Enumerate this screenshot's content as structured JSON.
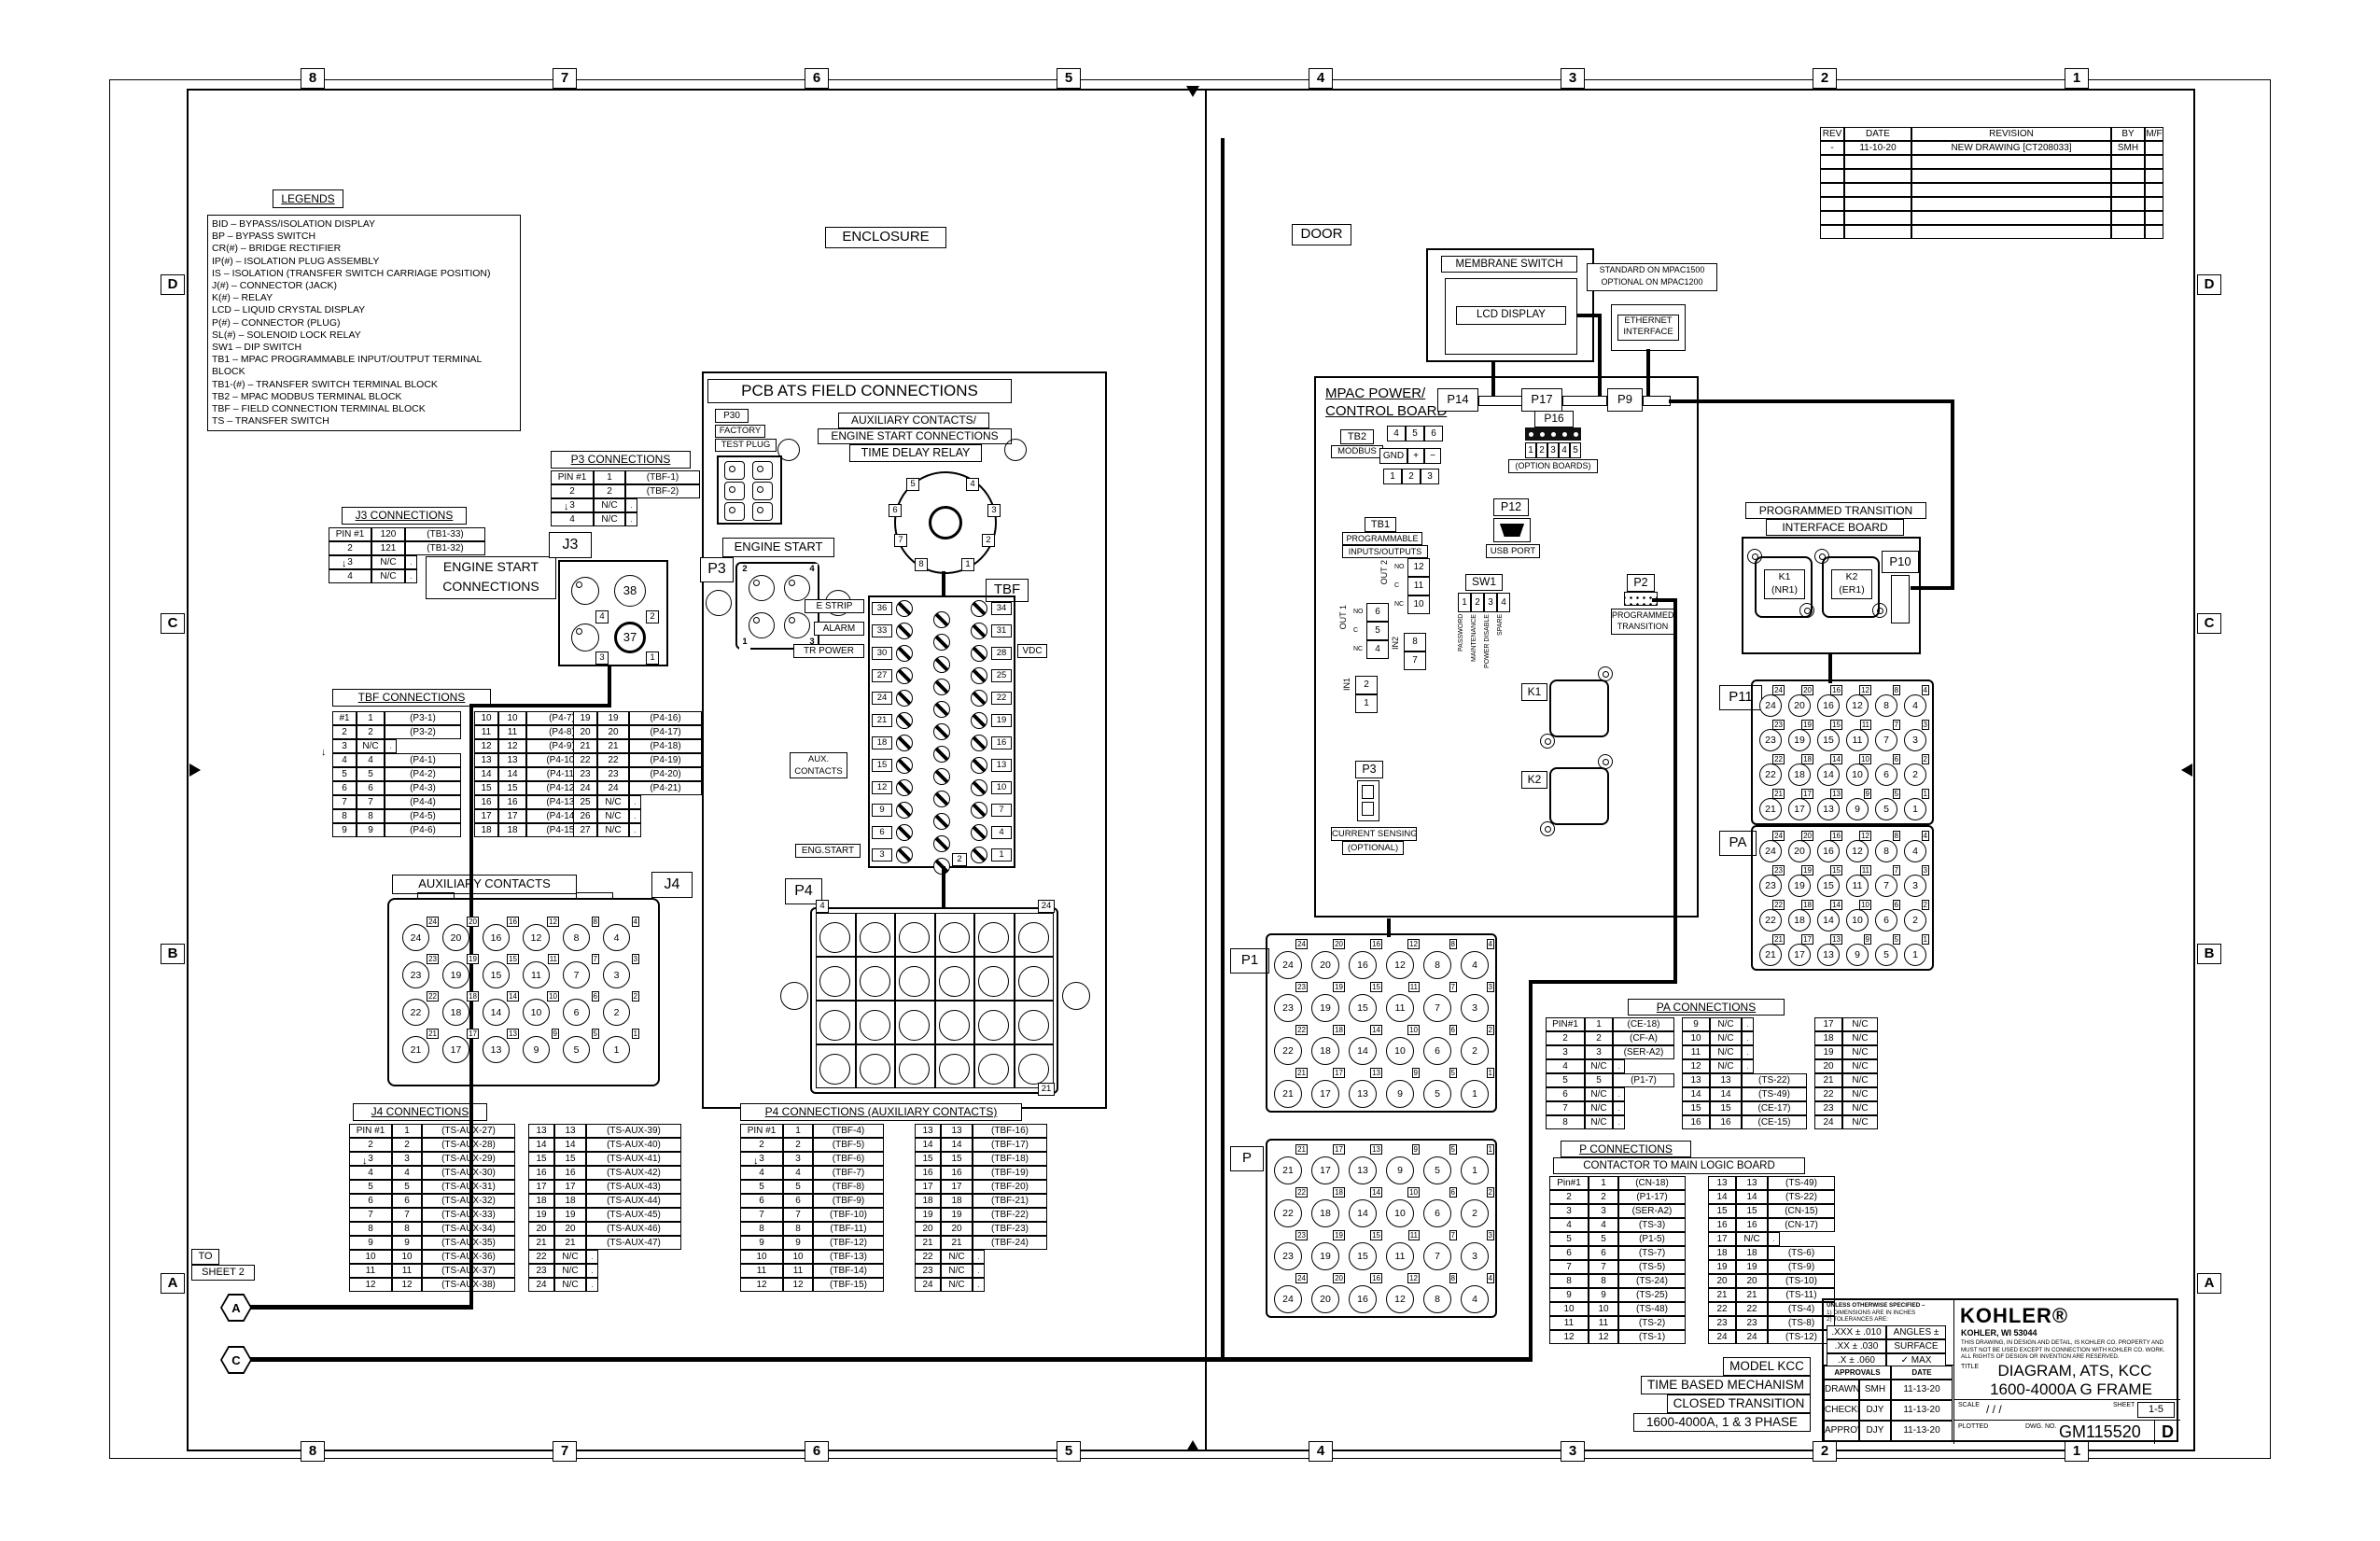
{
  "sheet": {
    "zone_cols": [
      "8",
      "7",
      "6",
      "5",
      "4",
      "3",
      "2",
      "1"
    ],
    "zone_rows": [
      "D",
      "C",
      "B",
      "A"
    ],
    "enclosure_label": "ENCLOSURE",
    "door_label": "DOOR",
    "to_sheet_1": "TO",
    "to_sheet_2": "SHEET 2",
    "flag_a": "A",
    "flag_c": "C"
  },
  "legends": {
    "title": "LEGENDS",
    "entries": [
      "BID  –  BYPASS/ISOLATION DISPLAY",
      "BP  –  BYPASS SWITCH",
      "CR(#)  –  BRIDGE RECTIFIER",
      "IP(#)  –  ISOLATION PLUG ASSEMBLY",
      "IS  –  ISOLATION (TRANSFER SWITCH CARRIAGE POSITION)",
      "J(#)  –  CONNECTOR (JACK)",
      "K(#)  –  RELAY",
      "LCD  –  LIQUID CRYSTAL DISPLAY",
      "P(#)  –  CONNECTOR (PLUG)",
      "SL(#) –  SOLENOID LOCK RELAY",
      "SW1  –  DIP SWITCH",
      "TB1  –  MPAC PROGRAMMABLE INPUT/OUTPUT TERMINAL BLOCK",
      "TB1-(#)  –  TRANSFER SWITCH TERMINAL BLOCK",
      "TB2  –  MPAC  MODBUS TERMINAL BLOCK",
      "TBF  –  FIELD CONNECTION TERMINAL BLOCK",
      "TS  –  TRANSFER SWITCH"
    ]
  },
  "revisions": {
    "rows": [
      [
        "REV",
        "DATE",
        "REVISION",
        "BY",
        "M/F"
      ],
      [
        "-",
        "11-10-20",
        "NEW DRAWING [CT208033]",
        "SMH",
        ""
      ],
      [
        "",
        "",
        "",
        "",
        ""
      ],
      [
        "",
        "",
        "",
        "",
        ""
      ],
      [
        "",
        "",
        "",
        "",
        ""
      ],
      [
        "",
        "",
        "",
        "",
        ""
      ],
      [
        "",
        "",
        "",
        "",
        ""
      ],
      [
        "",
        "",
        "",
        "",
        ""
      ]
    ]
  },
  "tables": {
    "j3": {
      "title": "J3 CONNECTIONS",
      "groups": [
        [
          [
            "PIN #1",
            "120",
            "(TB1-33)"
          ],
          [
            "2",
            "121",
            "(TB1-32)"
          ],
          [
            "3",
            "N/C",
            "."
          ],
          [
            "4",
            "N/C",
            "."
          ]
        ]
      ]
    },
    "p3": {
      "title": "P3 CONNECTIONS",
      "groups": [
        [
          [
            "PIN #1",
            "1",
            "(TBF-1)"
          ],
          [
            "2",
            "2",
            "(TBF-2)"
          ],
          [
            "3",
            "N/C",
            "."
          ],
          [
            "4",
            "N/C",
            "."
          ]
        ]
      ]
    },
    "tbf": {
      "title": "TBF CONNECTIONS",
      "groups": [
        [
          [
            "#1",
            "1",
            "(P3-1)"
          ],
          [
            "2",
            "2",
            "(P3-2)"
          ],
          [
            "3",
            "N/C",
            "."
          ],
          [
            "4",
            "4",
            "(P4-1)"
          ],
          [
            "5",
            "5",
            "(P4-2)"
          ],
          [
            "6",
            "6",
            "(P4-3)"
          ],
          [
            "7",
            "7",
            "(P4-4)"
          ],
          [
            "8",
            "8",
            "(P4-5)"
          ],
          [
            "9",
            "9",
            "(P4-6)"
          ]
        ],
        [
          [
            "10",
            "10",
            "(P4-7)"
          ],
          [
            "11",
            "11",
            "(P4-8)"
          ],
          [
            "12",
            "12",
            "(P4-9)"
          ],
          [
            "13",
            "13",
            "(P4-10)"
          ],
          [
            "14",
            "14",
            "(P4-11)"
          ],
          [
            "15",
            "15",
            "(P4-12)"
          ],
          [
            "16",
            "16",
            "(P4-13)"
          ],
          [
            "17",
            "17",
            "(P4-14)"
          ],
          [
            "18",
            "18",
            "(P4-15)"
          ]
        ],
        [
          [
            "19",
            "19",
            "(P4-16)"
          ],
          [
            "20",
            "20",
            "(P4-17)"
          ],
          [
            "21",
            "21",
            "(P4-18)"
          ],
          [
            "22",
            "22",
            "(P4-19)"
          ],
          [
            "23",
            "23",
            "(P4-20)"
          ],
          [
            "24",
            "24",
            "(P4-21)"
          ],
          [
            "25",
            "N/C",
            "."
          ],
          [
            "26",
            "N/C",
            "."
          ],
          [
            "27",
            "N/C",
            "."
          ]
        ]
      ]
    },
    "j4": {
      "title": "J4 CONNECTIONS",
      "groups": [
        [
          [
            "PIN #1",
            "1",
            "(TS-AUX-27)"
          ],
          [
            "2",
            "2",
            "(TS-AUX-28)"
          ],
          [
            "3",
            "3",
            "(TS-AUX-29)"
          ],
          [
            "4",
            "4",
            "(TS-AUX-30)"
          ],
          [
            "5",
            "5",
            "(TS-AUX-31)"
          ],
          [
            "6",
            "6",
            "(TS-AUX-32)"
          ],
          [
            "7",
            "7",
            "(TS-AUX-33)"
          ],
          [
            "8",
            "8",
            "(TS-AUX-34)"
          ],
          [
            "9",
            "9",
            "(TS-AUX-35)"
          ],
          [
            "10",
            "10",
            "(TS-AUX-36)"
          ],
          [
            "11",
            "11",
            "(TS-AUX-37)"
          ],
          [
            "12",
            "12",
            "(TS-AUX-38)"
          ]
        ],
        [
          [
            "13",
            "13",
            "(TS-AUX-39)"
          ],
          [
            "14",
            "14",
            "(TS-AUX-40)"
          ],
          [
            "15",
            "15",
            "(TS-AUX-41)"
          ],
          [
            "16",
            "16",
            "(TS-AUX-42)"
          ],
          [
            "17",
            "17",
            "(TS-AUX-43)"
          ],
          [
            "18",
            "18",
            "(TS-AUX-44)"
          ],
          [
            "19",
            "19",
            "(TS-AUX-45)"
          ],
          [
            "20",
            "20",
            "(TS-AUX-46)"
          ],
          [
            "21",
            "21",
            "(TS-AUX-47)"
          ],
          [
            "22",
            "N/C",
            "."
          ],
          [
            "23",
            "N/C",
            "."
          ],
          [
            "24",
            "N/C",
            "."
          ]
        ]
      ]
    },
    "p4": {
      "title": "P4 CONNECTIONS (AUXILIARY CONTACTS)",
      "groups": [
        [
          [
            "PIN #1",
            "1",
            "(TBF-4)"
          ],
          [
            "2",
            "2",
            "(TBF-5)"
          ],
          [
            "3",
            "3",
            "(TBF-6)"
          ],
          [
            "4",
            "4",
            "(TBF-7)"
          ],
          [
            "5",
            "5",
            "(TBF-8)"
          ],
          [
            "6",
            "6",
            "(TBF-9)"
          ],
          [
            "7",
            "7",
            "(TBF-10)"
          ],
          [
            "8",
            "8",
            "(TBF-11)"
          ],
          [
            "9",
            "9",
            "(TBF-12)"
          ],
          [
            "10",
            "10",
            "(TBF-13)"
          ],
          [
            "11",
            "11",
            "(TBF-14)"
          ],
          [
            "12",
            "12",
            "(TBF-15)"
          ]
        ],
        [
          [
            "13",
            "13",
            "(TBF-16)"
          ],
          [
            "14",
            "14",
            "(TBF-17)"
          ],
          [
            "15",
            "15",
            "(TBF-18)"
          ],
          [
            "16",
            "16",
            "(TBF-19)"
          ],
          [
            "17",
            "17",
            "(TBF-20)"
          ],
          [
            "18",
            "18",
            "(TBF-21)"
          ],
          [
            "19",
            "19",
            "(TBF-22)"
          ],
          [
            "20",
            "20",
            "(TBF-23)"
          ],
          [
            "21",
            "21",
            "(TBF-24)"
          ],
          [
            "22",
            "N/C",
            "."
          ],
          [
            "23",
            "N/C",
            "."
          ],
          [
            "24",
            "N/C",
            "."
          ]
        ]
      ]
    },
    "pa": {
      "title": "PA CONNECTIONS",
      "groups": [
        [
          [
            "PIN#1",
            "1",
            "(CE-18)"
          ],
          [
            "2",
            "2",
            "(CF-A)"
          ],
          [
            "3",
            "3",
            "(SER-A2)"
          ],
          [
            "4",
            "N/C",
            "."
          ],
          [
            "5",
            "5",
            "(P1-7)"
          ],
          [
            "6",
            "N/C",
            "."
          ],
          [
            "7",
            "N/C",
            "."
          ],
          [
            "8",
            "N/C",
            "."
          ]
        ],
        [
          [
            "9",
            "N/C",
            "."
          ],
          [
            "10",
            "N/C",
            "."
          ],
          [
            "11",
            "N/C",
            "."
          ],
          [
            "12",
            "N/C",
            "."
          ],
          [
            "13",
            "13",
            "(TS-22)"
          ],
          [
            "14",
            "14",
            "(TS-49)"
          ],
          [
            "15",
            "15",
            "(CE-17)"
          ],
          [
            "16",
            "16",
            "(CE-15)"
          ]
        ],
        [
          [
            "17",
            "N/C"
          ],
          [
            "18",
            "N/C"
          ],
          [
            "19",
            "N/C"
          ],
          [
            "20",
            "N/C"
          ],
          [
            "21",
            "N/C"
          ],
          [
            "22",
            "N/C"
          ],
          [
            "23",
            "N/C"
          ],
          [
            "24",
            "N/C"
          ]
        ]
      ]
    },
    "p": {
      "title": "P CONNECTIONS",
      "subtitle": "CONTACTOR TO MAIN LOGIC BOARD",
      "groups": [
        [
          [
            "Pin#1",
            "1",
            "(CN-18)"
          ],
          [
            "2",
            "2",
            "(P1-17)"
          ],
          [
            "3",
            "3",
            "(SER-A2)"
          ],
          [
            "4",
            "4",
            "(TS-3)"
          ],
          [
            "5",
            "5",
            "(P1-5)"
          ],
          [
            "6",
            "6",
            "(TS-7)"
          ],
          [
            "7",
            "7",
            "(TS-5)"
          ],
          [
            "8",
            "8",
            "(TS-24)"
          ],
          [
            "9",
            "9",
            "(TS-25)"
          ],
          [
            "10",
            "10",
            "(TS-48)"
          ],
          [
            "11",
            "11",
            "(TS-2)"
          ],
          [
            "12",
            "12",
            "(TS-1)"
          ]
        ],
        [
          [
            "13",
            "13",
            "(TS-49)"
          ],
          [
            "14",
            "14",
            "(TS-22)"
          ],
          [
            "15",
            "15",
            "(CN-15)"
          ],
          [
            "16",
            "16",
            "(CN-17)"
          ],
          [
            "17",
            "N/C",
            "."
          ],
          [
            "18",
            "18",
            "(TS-6)"
          ],
          [
            "19",
            "19",
            "(TS-9)"
          ],
          [
            "20",
            "20",
            "(TS-10)"
          ],
          [
            "21",
            "21",
            "(TS-11)"
          ],
          [
            "22",
            "22",
            "(TS-4)"
          ],
          [
            "23",
            "23",
            "(TS-8)"
          ],
          [
            "24",
            "24",
            "(TS-12)"
          ]
        ]
      ]
    }
  },
  "pcb": {
    "title": "PCB ATS FIELD CONNECTIONS",
    "subtitle1": "AUXILIARY CONTACTS/",
    "subtitle2": "ENGINE START CONNECTIONS",
    "subtitle3": "TIME DELAY RELAY",
    "p30": "P30",
    "p30_l1": "FACTORY",
    "p30_l2": "TEST PLUG",
    "engine_start": "ENGINE START",
    "p3": "P3",
    "tbf": "TBF",
    "p4": "P4",
    "j3": "J3",
    "j4": "J4",
    "aux_title": "AUXILIARY CONTACTS",
    "engine_conn_1": "ENGINE START",
    "engine_conn_2": "CONNECTIONS",
    "j3_pins": {
      "c38": "38",
      "c37": "37",
      "p1": "1",
      "p2": "2",
      "p3": "3",
      "p4": "4"
    },
    "p3_pins": {
      "p1": "1",
      "p2": "2",
      "p3": "3",
      "p4": "4"
    },
    "relay_pins": [
      "1",
      "2",
      "3",
      "4",
      "5",
      "6",
      "7",
      "8"
    ],
    "p4_corner_tl": "4",
    "p4_corner_tr": "24",
    "p4_corner_br": "21",
    "strip": {
      "left": [
        "36",
        "33",
        "30",
        "27",
        "24",
        "21",
        "18",
        "15",
        "12",
        "9",
        "6",
        "3"
      ],
      "right": [
        "34",
        "31",
        "28",
        "25",
        "22",
        "19",
        "16",
        "13",
        "10",
        "7",
        "4",
        "1"
      ],
      "bottom": "2"
    },
    "strip_labels": {
      "e_strip": "E STRIP",
      "alarm": "ALARM",
      "tr_power": "TR POWER",
      "aux1": "AUX.",
      "aux2": "CONTACTS",
      "eng_start": "ENG.START",
      "vdc": "VDC"
    }
  },
  "door": {
    "membrane": "MEMBRANE SWITCH",
    "lcd": "LCD DISPLAY",
    "standard1": "STANDARD ON MPAC1500",
    "standard2": "OPTIONAL ON MPAC1200",
    "ethernet1": "ETHERNET",
    "ethernet2": "INTERFACE",
    "mpac1": "MPAC POWER/",
    "mpac2": "CONTROL BOARD",
    "p14": "P14",
    "p17": "P17",
    "p9": "P9",
    "p16": "P16",
    "p16_pins": [
      "1",
      "2",
      "3",
      "4",
      "5"
    ],
    "option_boards": "(OPTION BOARDS)",
    "tb2": "TB2",
    "modbus": "MODBUS",
    "tb2_row1": [
      "4",
      "5",
      "6"
    ],
    "tb2_row2": [
      "GND",
      "+",
      "−"
    ],
    "tb2_row3": [
      "1",
      "2",
      "3"
    ],
    "tb1": "TB1",
    "tb1_l1": "PROGRAMMABLE",
    "tb1_l2": "INPUTS/OUTPUTS",
    "out2": "OUT 2",
    "out1": "OUT 1",
    "in2": "IN2",
    "in1": "IN1",
    "out2_terms": [
      "12",
      "11",
      "10"
    ],
    "out2_tags": [
      "NO",
      "C",
      "NC"
    ],
    "out1_terms": [
      "6",
      "5",
      "4"
    ],
    "out1_tags": [
      "NO",
      "C",
      "NC"
    ],
    "in2_terms": [
      "8",
      "7"
    ],
    "in1_terms": [
      "2",
      "1"
    ],
    "sw1": "SW1",
    "sw_pins": [
      "1",
      "2",
      "3",
      "4"
    ],
    "sw_labels": [
      "PASSWORD",
      "MAINTENANCE",
      "POWER DISABLE",
      "SPARE"
    ],
    "p12": "P12",
    "usb": "USB PORT",
    "p2": "P2",
    "pt1": "PROGRAMMED",
    "pt2": "TRANSITION",
    "k1": "K1",
    "k2": "K2",
    "p3": "P3",
    "cs1": "CURRENT SENSING",
    "cs2": "(OPTIONAL)",
    "ptib1": "PROGRAMMED TRANSITION",
    "ptib2": "INTERFACE BOARD",
    "k1_name": "K1",
    "k1_ref": "(NR1)",
    "k2_name": "K2",
    "k2_ref": "(ER1)",
    "p10": "P10",
    "p11": "P11",
    "pa": "PA",
    "p1": "P1",
    "p": "P"
  },
  "grids": {
    "std": [
      [
        "24",
        "20",
        "16",
        "12",
        "8",
        "4"
      ],
      [
        "23",
        "19",
        "15",
        "11",
        "7",
        "3"
      ],
      [
        "22",
        "18",
        "14",
        "10",
        "6",
        "2"
      ],
      [
        "21",
        "17",
        "13",
        "9",
        "5",
        "1"
      ]
    ],
    "flip": [
      [
        "21",
        "17",
        "13",
        "9",
        "5",
        "1"
      ],
      [
        "22",
        "18",
        "14",
        "10",
        "6",
        "2"
      ],
      [
        "23",
        "19",
        "15",
        "11",
        "7",
        "3"
      ],
      [
        "24",
        "20",
        "16",
        "12",
        "8",
        "4"
      ]
    ],
    "blank": [
      [
        "",
        "",
        "",
        "",
        "",
        ""
      ],
      [
        "",
        "",
        "",
        "",
        "",
        ""
      ],
      [
        "",
        "",
        "",
        "",
        "",
        ""
      ],
      [
        "",
        "",
        "",
        "",
        "",
        ""
      ]
    ]
  },
  "model_block": {
    "l1": "MODEL KCC",
    "l2": "TIME BASED MECHANISM",
    "l3": "CLOSED TRANSITION",
    "l4": "1600-4000A, 1 & 3 PHASE"
  },
  "title_block": {
    "brand": "KOHLER®",
    "brand_sub": "KOHLER, WI  53044",
    "notice1": "THIS DRAWING, IN DESIGN AND DETAIL, IS KOHLER CO. PROPERTY AND",
    "notice2": "MUST NOT BE USED EXCEPT IN CONNECTION WITH KOHLER CO. WORK.",
    "notice3": "ALL RIGHTS OF DESIGN OR INVENTION ARE RESERVED.",
    "title_label": "TITLE",
    "title1": "DIAGRAM, ATS, KCC",
    "title2": "1600-4000A G FRAME",
    "scale_label": "SCALE",
    "scale_value": "/ / /",
    "plotted_label": "PLOTTED",
    "sheet_label": "SHEET",
    "sheet_value": "1-5",
    "dwg_label": "DWG. NO.",
    "dwg_value": "GM115520",
    "size": "D",
    "tol_title": "UNLESS OTHERWISE SPECIFIED –",
    "tol1": "1) DIMENSIONS ARE IN INCHES",
    "tol2": "2) TOLERANCES ARE:",
    "tol_rows": [
      [
        ".XXX ± .010",
        "ANGLES ± 1/2°"
      ],
      [
        ".XX ± .030",
        "SURFACE FINISH"
      ],
      [
        ".X ± .060",
        "✓ MAX"
      ],
      [
        "FRACTIONS ±",
        ""
      ]
    ],
    "approvals_label": "APPROVALS",
    "date_label": "DATE",
    "approval_rows": [
      [
        "DRAWN",
        "SMH",
        "11-13-20"
      ],
      [
        "CHECKED",
        "DJY",
        "11-13-20"
      ],
      [
        "APPROVED",
        "DJY",
        "11-13-20"
      ]
    ]
  }
}
